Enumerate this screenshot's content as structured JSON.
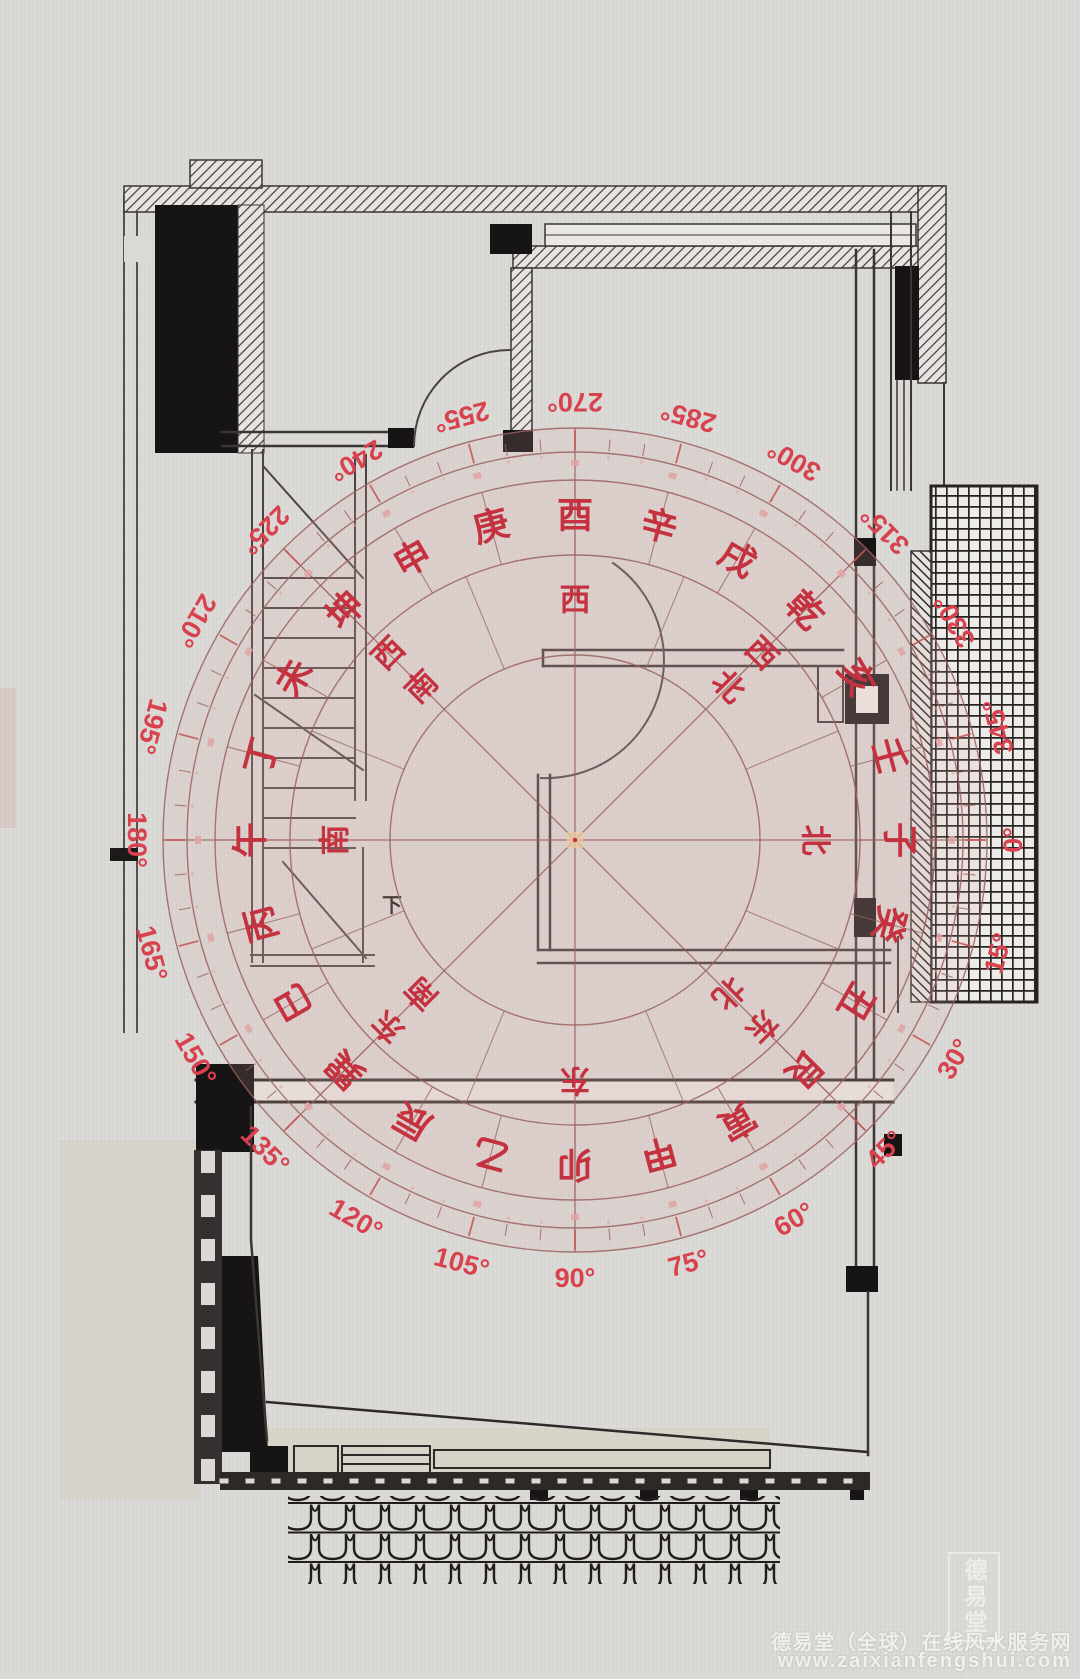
{
  "compass": {
    "degree_labels": [
      "0°",
      "15°",
      "30°",
      "45°",
      "60°",
      "75°",
      "90°",
      "105°",
      "120°",
      "135°",
      "150°",
      "165°",
      "180°",
      "195°",
      "210°",
      "225°",
      "240°",
      "255°",
      "270°",
      "285°",
      "300°",
      "315°",
      "330°",
      "345°"
    ],
    "mountains": [
      "子",
      "癸",
      "丑",
      "艮",
      "寅",
      "甲",
      "卯",
      "乙",
      "辰",
      "巽",
      "巳",
      "丙",
      "午",
      "丁",
      "未",
      "坤",
      "申",
      "庚",
      "酉",
      "辛",
      "戌",
      "乾",
      "亥",
      "壬"
    ],
    "directions": [
      {
        "label": "北",
        "deg": 0
      },
      {
        "label": "东北",
        "deg": 45
      },
      {
        "label": "东",
        "deg": 90
      },
      {
        "label": "东南",
        "deg": 135
      },
      {
        "label": "南",
        "deg": 180
      },
      {
        "label": "西南",
        "deg": 225
      },
      {
        "label": "西",
        "deg": 270
      },
      {
        "label": "西北",
        "deg": 315
      }
    ],
    "colors": {
      "ring_line": "#9a625f",
      "mountain_text": "#c5323f",
      "direction_text": "#c5323f",
      "degree_text": "#d8424e",
      "tick_blob": "#e2a3a3",
      "wash": "rgba(226,172,172,0.16)"
    }
  },
  "plan": {
    "stair_down_label": "下"
  },
  "watermark": {
    "line1": "德易堂（全球）在线风水服务网",
    "line2": "www.zaixianfengshui.com",
    "seal": "德易堂"
  }
}
